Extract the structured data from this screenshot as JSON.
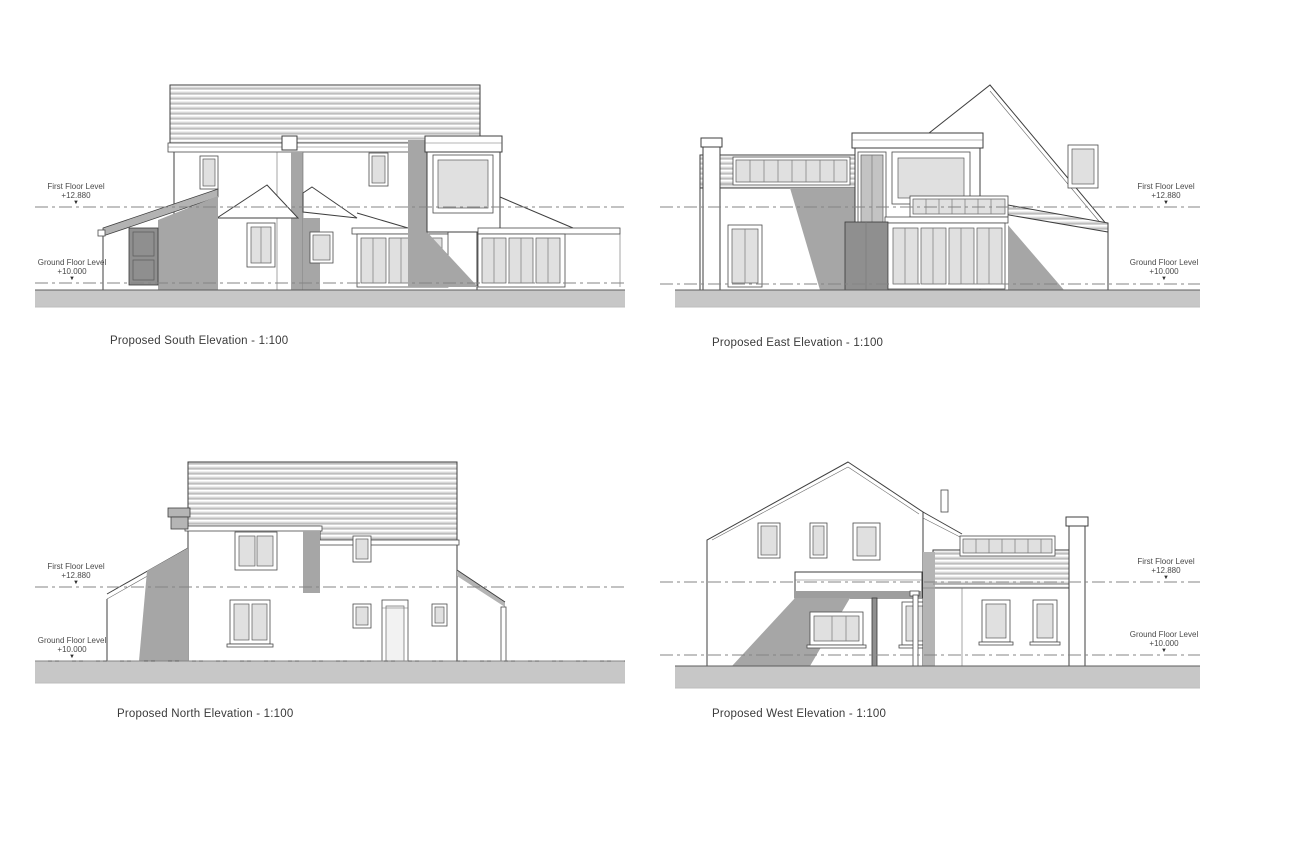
{
  "sheet": {
    "background": "#ffffff"
  },
  "icons": {
    "level_marker": "▼"
  },
  "palette": {
    "line": "#3f3f3f",
    "shadow": "#a6a6a6",
    "glass": "#e0e0e0",
    "roof_stripe": "#d8d8d8",
    "ground": "#c7c7c7",
    "datum_line": "#848484"
  },
  "elevations": [
    {
      "id": "south",
      "title": "Proposed South Elevation - 1:100",
      "levels": [
        {
          "label": "First Floor Level",
          "value": "+12.880"
        },
        {
          "label": "Ground Floor Level",
          "value": "+10.000"
        }
      ]
    },
    {
      "id": "east",
      "title": "Proposed East Elevation - 1:100",
      "levels": [
        {
          "label": "First Floor Level",
          "value": "+12.880"
        },
        {
          "label": "Ground Floor Level",
          "value": "+10.000"
        }
      ]
    },
    {
      "id": "north",
      "title": "Proposed North Elevation - 1:100",
      "levels": [
        {
          "label": "First Floor Level",
          "value": "+12.880"
        },
        {
          "label": "Ground Floor Level",
          "value": "+10.000"
        }
      ]
    },
    {
      "id": "west",
      "title": "Proposed West Elevation - 1:100",
      "levels": [
        {
          "label": "First Floor Level",
          "value": "+12.880"
        },
        {
          "label": "Ground Floor Level",
          "value": "+10.000"
        }
      ]
    }
  ]
}
